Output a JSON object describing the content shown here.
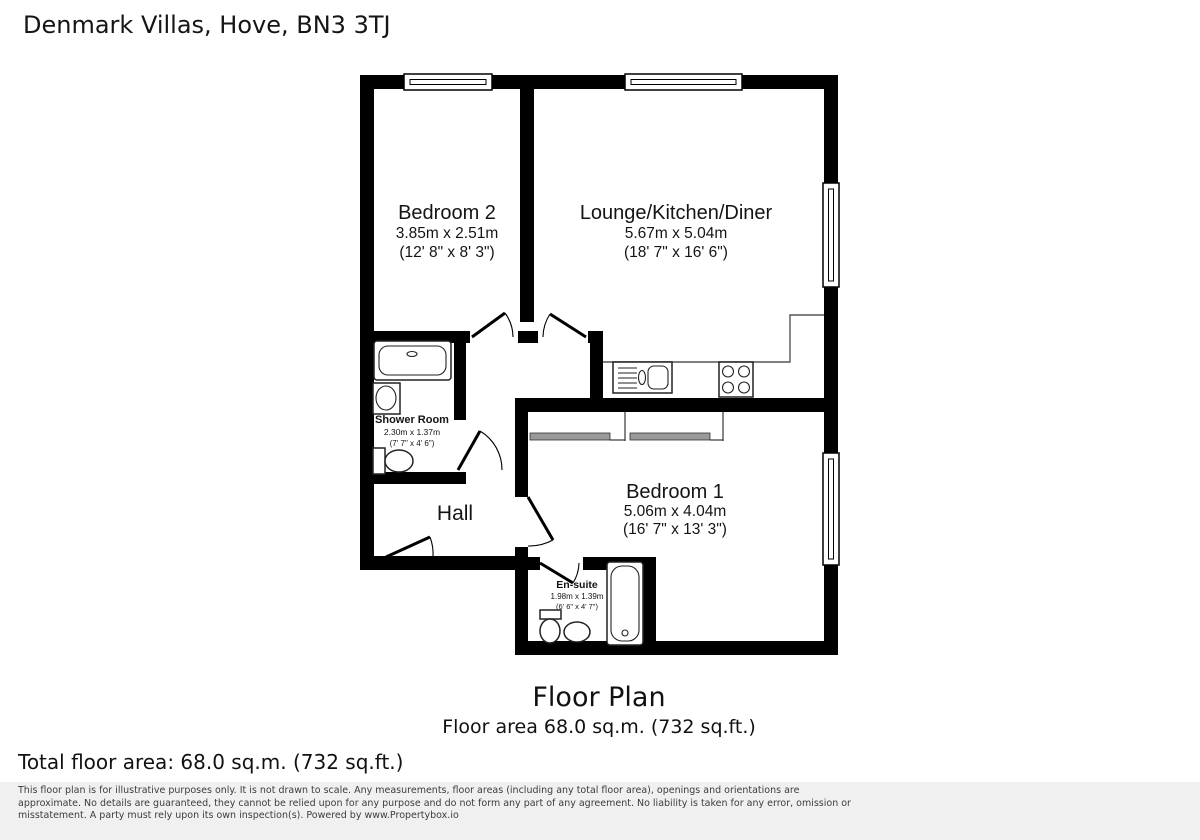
{
  "page": {
    "title": "Denmark Villas, Hove, BN3 3TJ"
  },
  "plan": {
    "rooms": [
      {
        "id": "bedroom2",
        "name": "Bedroom 2",
        "metric": "3.85m x 2.51m",
        "imperial": "(12' 8\" x 8' 3\")"
      },
      {
        "id": "lounge-kitchen-diner",
        "name": "Lounge/Kitchen/Diner",
        "metric": "5.67m x 5.04m",
        "imperial": "(18' 7\" x 16' 6\")"
      },
      {
        "id": "shower-room",
        "name": "Shower Room",
        "metric": "2.30m x 1.37m",
        "imperial": "(7' 7\" x 4' 6\")"
      },
      {
        "id": "hall",
        "name": "Hall"
      },
      {
        "id": "bedroom1",
        "name": "Bedroom 1",
        "metric": "5.06m x 4.04m",
        "imperial": "(16' 7\" x 13' 3\")"
      },
      {
        "id": "ensuite",
        "name": "En-suite",
        "metric": "1.98m x 1.39m",
        "imperial": "(6' 6\" x 4' 7\")"
      }
    ],
    "caption_title": "Floor Plan",
    "caption_area": "Floor area 68.0 sq.m. (732 sq.ft.)"
  },
  "footer": {
    "total_area": "Total floor area: 68.0 sq.m. (732 sq.ft.)",
    "disclaimer_line1": "This floor plan is for illustrative purposes only. It is not drawn to scale. Any measurements, floor areas (including any total floor area), openings and orientations are",
    "disclaimer_line2": "approximate. No details are guaranteed, they cannot be relied upon for any purpose and do not form any part of any agreement. No liability is taken for any error, omission or",
    "disclaimer_line3": "misstatement. A party must rely upon its own inspection(s). Powered by www.Propertybox.io"
  },
  "colors": {
    "wall": "#000000",
    "background": "#ffffff",
    "disclaimer_band": "#f0f0f0",
    "wardrobe_door": "#9a9a9a"
  }
}
